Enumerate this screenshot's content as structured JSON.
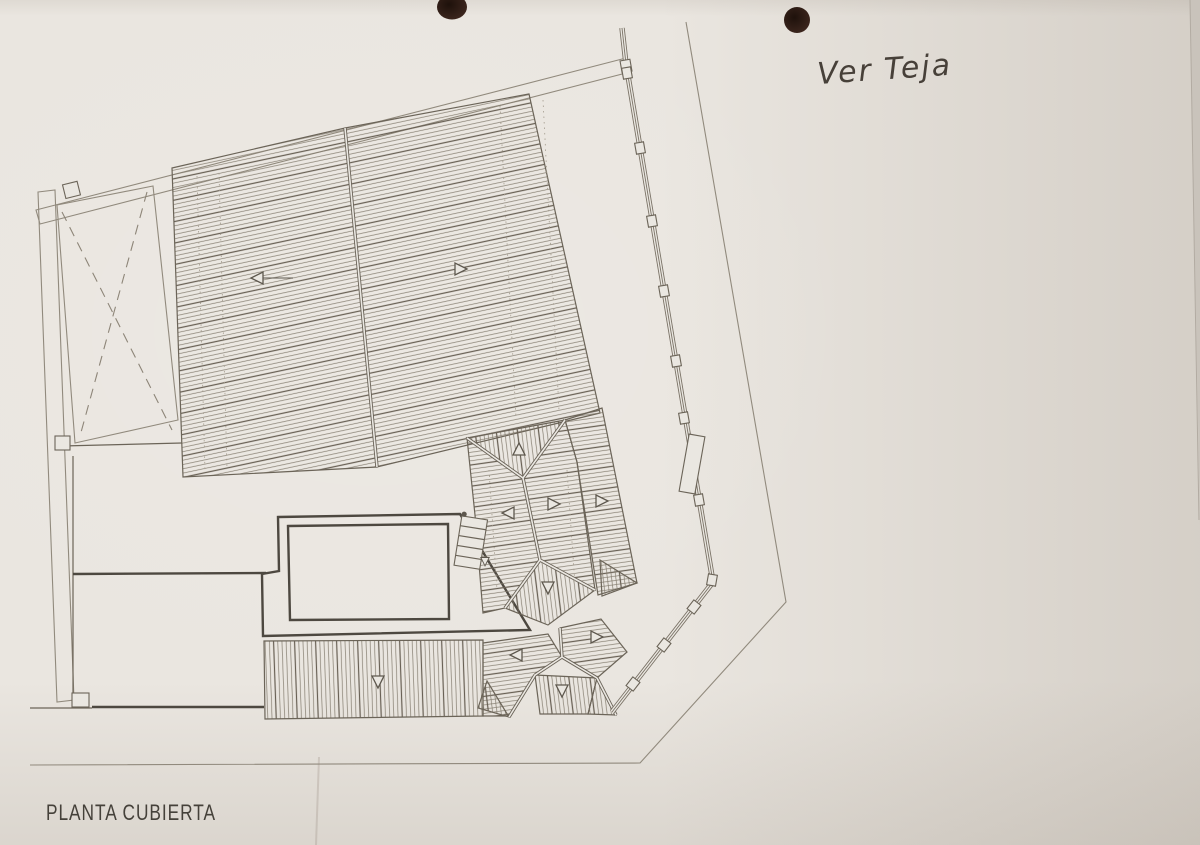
{
  "plan": {
    "title": "PLANTA CUBIERTA",
    "handwritten_note": "Ver Teja",
    "slope_arrows": [
      {
        "x": 258,
        "y": 278,
        "dir": "left",
        "tail": 30
      },
      {
        "x": 460,
        "y": 269,
        "dir": "right",
        "tail": 0
      },
      {
        "x": 519,
        "y": 450,
        "dir": "up",
        "tail": 0
      },
      {
        "x": 509,
        "y": 513,
        "dir": "left",
        "tail": 0
      },
      {
        "x": 553,
        "y": 504,
        "dir": "right",
        "tail": 0
      },
      {
        "x": 601,
        "y": 501,
        "dir": "right",
        "tail": 0
      },
      {
        "x": 548,
        "y": 587,
        "dir": "down",
        "tail": 0
      },
      {
        "x": 517,
        "y": 655,
        "dir": "left",
        "tail": 0
      },
      {
        "x": 596,
        "y": 637,
        "dir": "right",
        "tail": 0
      },
      {
        "x": 562,
        "y": 690,
        "dir": "down",
        "tail": 0
      },
      {
        "x": 378,
        "y": 681,
        "dir": "down",
        "tail": 0
      },
      {
        "x": 485,
        "y": 561,
        "dir": "down",
        "small": true
      }
    ],
    "colors": {
      "paper": "#eae6e0",
      "drawing_ink": "#6b6458",
      "heavy_ink": "#4d4840",
      "hatch_ink": "#80796c",
      "title_ink": "#45413a",
      "handwriting_ink": "#474039",
      "punch_hole": "#3a241c"
    }
  }
}
